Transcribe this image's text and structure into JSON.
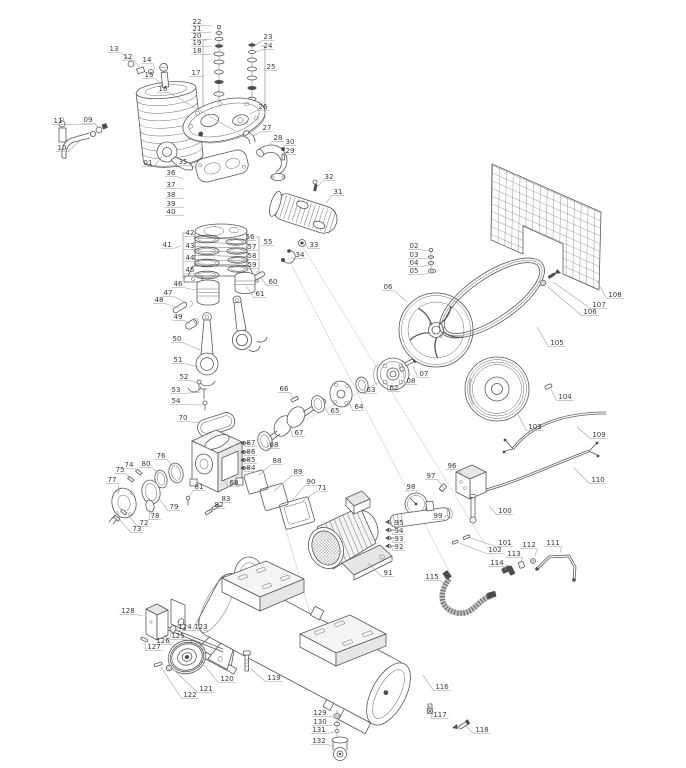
{
  "figure": {
    "type": "exploded-parts-diagram",
    "subject": "belt-driven air compressor",
    "background": "#ffffff",
    "ink": "#585858",
    "leader_color": "#9a9a9a",
    "label_color": "#3a3a3a",
    "part_count": 132
  },
  "parts": [
    {
      "n": "01",
      "x": 148,
      "y": 164,
      "tx": 162,
      "ty": 156
    },
    {
      "n": "02",
      "x": 414,
      "y": 247,
      "tx": 429,
      "ty": 251
    },
    {
      "n": "03",
      "x": 414,
      "y": 256,
      "tx": 429,
      "ty": 258
    },
    {
      "n": "04",
      "x": 414,
      "y": 264,
      "tx": 429,
      "ty": 265
    },
    {
      "n": "05",
      "x": 414,
      "y": 272,
      "tx": 429,
      "ty": 273
    },
    {
      "n": "06",
      "x": 388,
      "y": 288,
      "tx": 407,
      "ty": 302
    },
    {
      "n": "07",
      "x": 424,
      "y": 375,
      "tx": 413,
      "ty": 366
    },
    {
      "n": "08",
      "x": 411,
      "y": 382,
      "tx": 403,
      "ty": 370
    },
    {
      "n": "09",
      "x": 88,
      "y": 121,
      "tx": 100,
      "ty": 128
    },
    {
      "n": "10",
      "x": 62,
      "y": 149,
      "tx": 82,
      "ty": 139
    },
    {
      "n": "11",
      "x": 58,
      "y": 122,
      "tx": 97,
      "ty": 124
    },
    {
      "n": "12",
      "x": 128,
      "y": 58,
      "tx": 140,
      "ty": 68
    },
    {
      "n": "13",
      "x": 114,
      "y": 50,
      "tx": 131,
      "ty": 60
    },
    {
      "n": "14",
      "x": 147,
      "y": 61,
      "tx": 155,
      "ty": 70
    },
    {
      "n": "15",
      "x": 149,
      "y": 76,
      "tx": 162,
      "ty": 85
    },
    {
      "n": "16",
      "x": 163,
      "y": 90,
      "tx": 235,
      "ty": 131
    },
    {
      "n": "17",
      "x": 196,
      "y": 74,
      "tx": 203,
      "ty": 74
    },
    {
      "n": "18",
      "x": 197,
      "y": 52,
      "tx": 212,
      "ty": 54
    },
    {
      "n": "19",
      "x": 197,
      "y": 44,
      "tx": 212,
      "ty": 46
    },
    {
      "n": "20",
      "x": 197,
      "y": 37,
      "tx": 212,
      "ty": 39
    },
    {
      "n": "21",
      "x": 197,
      "y": 30,
      "tx": 212,
      "ty": 32
    },
    {
      "n": "22",
      "x": 197,
      "y": 23,
      "tx": 212,
      "ty": 26
    },
    {
      "n": "23",
      "x": 268,
      "y": 38,
      "tx": 256,
      "ty": 45
    },
    {
      "n": "24",
      "x": 268,
      "y": 47,
      "tx": 256,
      "ty": 52
    },
    {
      "n": "25",
      "x": 271,
      "y": 68,
      "tx": 264,
      "ty": 68
    },
    {
      "n": "26",
      "x": 263,
      "y": 108,
      "tx": 250,
      "ty": 114
    },
    {
      "n": "27",
      "x": 267,
      "y": 129,
      "tx": 254,
      "ty": 136
    },
    {
      "n": "28",
      "x": 278,
      "y": 139,
      "tx": 268,
      "ty": 147
    },
    {
      "n": "29",
      "x": 290,
      "y": 152,
      "tx": 283,
      "ty": 156
    },
    {
      "n": "30",
      "x": 290,
      "y": 143,
      "tx": 283,
      "ty": 148
    },
    {
      "n": "31",
      "x": 338,
      "y": 193,
      "tx": 326,
      "ty": 203
    },
    {
      "n": "32",
      "x": 329,
      "y": 178,
      "tx": 318,
      "ty": 186
    },
    {
      "n": "33",
      "x": 314,
      "y": 246,
      "tx": 305,
      "ty": 244
    },
    {
      "n": "34",
      "x": 300,
      "y": 256,
      "tx": 291,
      "ty": 257
    },
    {
      "n": "35",
      "x": 183,
      "y": 163,
      "tx": 197,
      "ty": 167
    },
    {
      "n": "36",
      "x": 171,
      "y": 174,
      "tx": 184,
      "ty": 179
    },
    {
      "n": "37",
      "x": 171,
      "y": 186,
      "tx": 184,
      "ty": 189
    },
    {
      "n": "38",
      "x": 171,
      "y": 196,
      "tx": 184,
      "ty": 198
    },
    {
      "n": "39",
      "x": 171,
      "y": 205,
      "tx": 184,
      "ty": 207
    },
    {
      "n": "40",
      "x": 171,
      "y": 213,
      "tx": 184,
      "ty": 215
    },
    {
      "n": "41",
      "x": 167,
      "y": 246,
      "tx": 181,
      "ty": 246
    },
    {
      "n": "42",
      "x": 190,
      "y": 234,
      "tx": 199,
      "ty": 238
    },
    {
      "n": "43",
      "x": 190,
      "y": 247,
      "tx": 200,
      "ty": 250
    },
    {
      "n": "44",
      "x": 190,
      "y": 259,
      "tx": 200,
      "ty": 262
    },
    {
      "n": "45",
      "x": 190,
      "y": 271,
      "tx": 200,
      "ty": 274
    },
    {
      "n": "46",
      "x": 178,
      "y": 285,
      "tx": 196,
      "ty": 290
    },
    {
      "n": "47",
      "x": 168,
      "y": 294,
      "tx": 187,
      "ty": 303
    },
    {
      "n": "48",
      "x": 159,
      "y": 301,
      "tx": 179,
      "ty": 308
    },
    {
      "n": "49",
      "x": 178,
      "y": 318,
      "tx": 190,
      "ty": 324
    },
    {
      "n": "50",
      "x": 177,
      "y": 340,
      "tx": 200,
      "ty": 350
    },
    {
      "n": "51",
      "x": 178,
      "y": 361,
      "tx": 199,
      "ty": 367
    },
    {
      "n": "52",
      "x": 184,
      "y": 378,
      "tx": 198,
      "ty": 383
    },
    {
      "n": "53",
      "x": 176,
      "y": 391,
      "tx": 201,
      "ty": 392
    },
    {
      "n": "54",
      "x": 176,
      "y": 402,
      "tx": 203,
      "ty": 405
    },
    {
      "n": "55",
      "x": 268,
      "y": 243,
      "tx": 261,
      "ty": 247
    },
    {
      "n": "56",
      "x": 250,
      "y": 238,
      "tx": 241,
      "ty": 242
    },
    {
      "n": "57",
      "x": 252,
      "y": 248,
      "tx": 242,
      "ty": 251
    },
    {
      "n": "58",
      "x": 252,
      "y": 257,
      "tx": 243,
      "ty": 260
    },
    {
      "n": "59",
      "x": 252,
      "y": 266,
      "tx": 243,
      "ty": 269
    },
    {
      "n": "60",
      "x": 273,
      "y": 283,
      "tx": 261,
      "ty": 278
    },
    {
      "n": "61",
      "x": 260,
      "y": 295,
      "tx": 246,
      "ty": 286
    },
    {
      "n": "62",
      "x": 394,
      "y": 389,
      "tx": 387,
      "ty": 382
    },
    {
      "n": "63",
      "x": 371,
      "y": 391,
      "tx": 365,
      "ty": 385
    },
    {
      "n": "64",
      "x": 359,
      "y": 408,
      "tx": 348,
      "ty": 400
    },
    {
      "n": "65",
      "x": 335,
      "y": 412,
      "tx": 324,
      "ty": 406
    },
    {
      "n": "66",
      "x": 284,
      "y": 390,
      "tx": 294,
      "ty": 399
    },
    {
      "n": "67",
      "x": 299,
      "y": 434,
      "tx": 289,
      "ty": 425
    },
    {
      "n": "68",
      "x": 274,
      "y": 446,
      "tx": 267,
      "ty": 440
    },
    {
      "n": "69",
      "x": 234,
      "y": 484,
      "tx": 224,
      "ty": 479
    },
    {
      "n": "70",
      "x": 183,
      "y": 419,
      "tx": 199,
      "ty": 423
    },
    {
      "n": "71",
      "x": 322,
      "y": 489,
      "tx": 303,
      "ty": 501
    },
    {
      "n": "72",
      "x": 144,
      "y": 524,
      "tx": 128,
      "ty": 515
    },
    {
      "n": "73",
      "x": 137,
      "y": 530,
      "tx": 120,
      "ty": 520
    },
    {
      "n": "74",
      "x": 129,
      "y": 466,
      "tx": 137,
      "ty": 473
    },
    {
      "n": "75",
      "x": 120,
      "y": 471,
      "tx": 130,
      "ty": 479
    },
    {
      "n": "76",
      "x": 161,
      "y": 457,
      "tx": 173,
      "ty": 466
    },
    {
      "n": "77",
      "x": 112,
      "y": 481,
      "tx": 119,
      "ty": 492
    },
    {
      "n": "78",
      "x": 155,
      "y": 517,
      "tx": 150,
      "ty": 509
    },
    {
      "n": "79",
      "x": 174,
      "y": 508,
      "tx": 158,
      "ty": 497
    },
    {
      "n": "80",
      "x": 146,
      "y": 465,
      "tx": 158,
      "ty": 473
    },
    {
      "n": "81",
      "x": 199,
      "y": 488,
      "tx": 189,
      "ty": 497
    },
    {
      "n": "82",
      "x": 219,
      "y": 506,
      "tx": 209,
      "ty": 512
    },
    {
      "n": "83",
      "x": 226,
      "y": 500,
      "tx": 215,
      "ty": 507
    },
    {
      "n": "84",
      "x": 251,
      "y": 469,
      "tx": 244,
      "ty": 467
    },
    {
      "n": "85",
      "x": 251,
      "y": 461,
      "tx": 244,
      "ty": 459
    },
    {
      "n": "86",
      "x": 251,
      "y": 453,
      "tx": 244,
      "ty": 451
    },
    {
      "n": "87",
      "x": 251,
      "y": 444,
      "tx": 244,
      "ty": 443
    },
    {
      "n": "88",
      "x": 277,
      "y": 462,
      "tx": 259,
      "ty": 475
    },
    {
      "n": "89",
      "x": 298,
      "y": 473,
      "tx": 274,
      "ty": 491
    },
    {
      "n": "90",
      "x": 311,
      "y": 483,
      "tx": 291,
      "ty": 502
    },
    {
      "n": "91",
      "x": 388,
      "y": 574,
      "tx": 368,
      "ty": 563
    },
    {
      "n": "92",
      "x": 399,
      "y": 548,
      "tx": 391,
      "ty": 546
    },
    {
      "n": "93",
      "x": 399,
      "y": 540,
      "tx": 391,
      "ty": 538
    },
    {
      "n": "94",
      "x": 399,
      "y": 532,
      "tx": 391,
      "ty": 530
    },
    {
      "n": "95",
      "x": 399,
      "y": 524,
      "tx": 391,
      "ty": 522
    },
    {
      "n": "96",
      "x": 452,
      "y": 467,
      "tx": 461,
      "ty": 474
    },
    {
      "n": "97",
      "x": 431,
      "y": 477,
      "tx": 442,
      "ty": 485
    },
    {
      "n": "98",
      "x": 411,
      "y": 488,
      "tx": 415,
      "ty": 495
    },
    {
      "n": "99",
      "x": 438,
      "y": 517,
      "tx": 446,
      "ty": 515
    },
    {
      "n": "100",
      "x": 505,
      "y": 512,
      "tx": 489,
      "ty": 506
    },
    {
      "n": "101",
      "x": 505,
      "y": 544,
      "tx": 471,
      "ty": 538
    },
    {
      "n": "102",
      "x": 495,
      "y": 551,
      "tx": 459,
      "ty": 543
    },
    {
      "n": "103",
      "x": 535,
      "y": 428,
      "tx": 517,
      "ty": 412
    },
    {
      "n": "104",
      "x": 565,
      "y": 398,
      "tx": 551,
      "ty": 389
    },
    {
      "n": "105",
      "x": 557,
      "y": 344,
      "tx": 537,
      "ty": 327
    },
    {
      "n": "106",
      "x": 590,
      "y": 313,
      "tx": 548,
      "ty": 287
    },
    {
      "n": "107",
      "x": 599,
      "y": 306,
      "tx": 553,
      "ty": 282
    },
    {
      "n": "108",
      "x": 615,
      "y": 296,
      "tx": 597,
      "ty": 281
    },
    {
      "n": "109",
      "x": 599,
      "y": 436,
      "tx": 577,
      "ty": 427
    },
    {
      "n": "110",
      "x": 598,
      "y": 481,
      "tx": 574,
      "ty": 468
    },
    {
      "n": "111",
      "x": 553,
      "y": 544,
      "tx": 560,
      "ty": 553
    },
    {
      "n": "112",
      "x": 529,
      "y": 546,
      "tx": 535,
      "ty": 556
    },
    {
      "n": "113",
      "x": 514,
      "y": 555,
      "tx": 521,
      "ty": 563
    },
    {
      "n": "114",
      "x": 497,
      "y": 564,
      "tx": 506,
      "ty": 570
    },
    {
      "n": "115",
      "x": 432,
      "y": 578,
      "tx": 446,
      "ty": 584
    },
    {
      "n": "116",
      "x": 442,
      "y": 688,
      "tx": 423,
      "ty": 675
    },
    {
      "n": "117",
      "x": 440,
      "y": 716,
      "tx": 431,
      "ty": 712
    },
    {
      "n": "118",
      "x": 482,
      "y": 731,
      "tx": 466,
      "ty": 726
    },
    {
      "n": "119",
      "x": 274,
      "y": 679,
      "tx": 250,
      "ty": 668
    },
    {
      "n": "120",
      "x": 227,
      "y": 680,
      "tx": 204,
      "ty": 665
    },
    {
      "n": "121",
      "x": 206,
      "y": 690,
      "tx": 172,
      "ty": 668
    },
    {
      "n": "122",
      "x": 190,
      "y": 696,
      "tx": 161,
      "ty": 667
    },
    {
      "n": "123",
      "x": 201,
      "y": 628,
      "tx": 198,
      "ty": 619
    },
    {
      "n": "124",
      "x": 185,
      "y": 628,
      "tx": 179,
      "ty": 621
    },
    {
      "n": "125",
      "x": 178,
      "y": 637,
      "tx": 172,
      "ty": 629
    },
    {
      "n": "126",
      "x": 163,
      "y": 642,
      "tx": 164,
      "ty": 635
    },
    {
      "n": "127",
      "x": 154,
      "y": 648,
      "tx": 145,
      "ty": 641
    },
    {
      "n": "128",
      "x": 128,
      "y": 612,
      "tx": 143,
      "ty": 616
    },
    {
      "n": "129",
      "x": 320,
      "y": 714,
      "tx": 333,
      "ty": 717
    },
    {
      "n": "130",
      "x": 320,
      "y": 723,
      "tx": 334,
      "ty": 725
    },
    {
      "n": "131",
      "x": 319,
      "y": 731,
      "tx": 334,
      "ty": 732
    },
    {
      "n": "132",
      "x": 319,
      "y": 742,
      "tx": 332,
      "ty": 746
    }
  ]
}
